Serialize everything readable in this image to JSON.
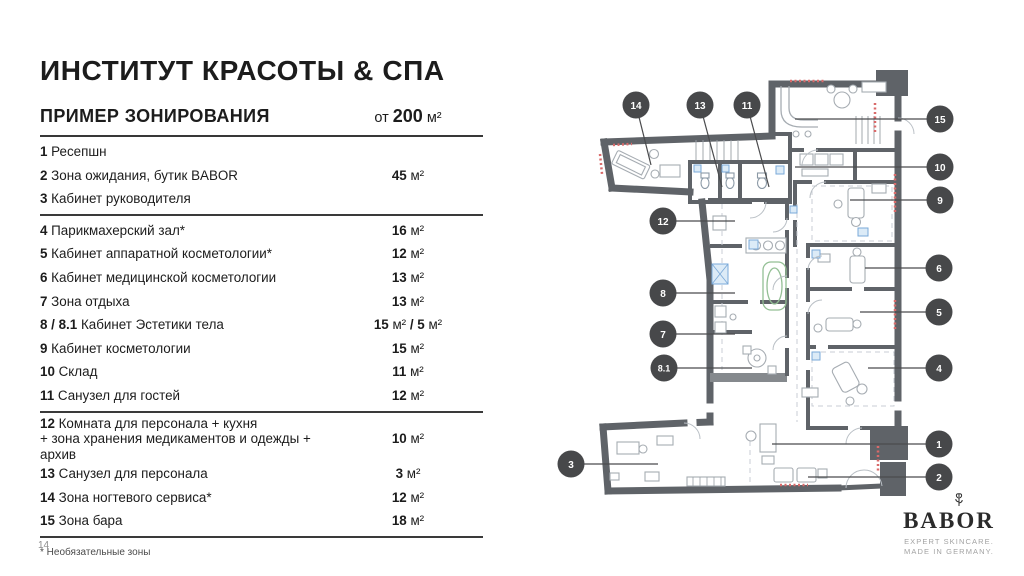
{
  "title": "ИНСТИТУТ КРАСОТЫ & СПА",
  "section": {
    "heading": "ПРИМЕР ЗОНИРОВАНИЯ",
    "min_area_prefix": "от ",
    "min_area_value": "200",
    "min_area_unit": " м²"
  },
  "zones": [
    {
      "num": "1",
      "name": "Ресепшн",
      "area_value": "",
      "area_unit": ""
    },
    {
      "num": "2",
      "name": "Зона ожидания, бутик BABOR",
      "area_value": "45",
      "area_unit": " м²"
    },
    {
      "num": "3",
      "name": "Кабинет руководителя",
      "area_value": "",
      "area_unit": "",
      "divider_after": true
    },
    {
      "num": "4",
      "name": "Парикмахерский зал*",
      "area_value": "16",
      "area_unit": " м²"
    },
    {
      "num": "5",
      "name": "Кабинет аппаратной косметологии*",
      "area_value": "12",
      "area_unit": " м²"
    },
    {
      "num": "6",
      "name": "Кабинет медицинской косметологии",
      "area_value": "13",
      "area_unit": " м²"
    },
    {
      "num": "7",
      "name": "Зона отдыха",
      "area_value": "13",
      "area_unit": " м²"
    },
    {
      "num": "8 / 8.1",
      "name": "Кабинет Эстетики тела",
      "area_value": "15",
      "area_unit": " м²",
      "area_value2": " / 5",
      "area_unit2": " м²"
    },
    {
      "num": "9",
      "name": "Кабинет косметологии",
      "area_value": "15",
      "area_unit": " м²"
    },
    {
      "num": "10",
      "name": "Склад",
      "area_value": "11",
      "area_unit": " м²"
    },
    {
      "num": "11",
      "name": "Санузел для гостей",
      "area_value": "12",
      "area_unit": " м²",
      "divider_after": true
    },
    {
      "num": "12",
      "name": "Комната для персонала + кухня",
      "name2": "+ зона хранения медикаментов и одежды + архив",
      "area_value": "10",
      "area_unit": " м²"
    },
    {
      "num": "13",
      "name": "Санузел для персонала",
      "area_value": "3",
      "area_unit": " м²"
    },
    {
      "num": "14",
      "name": "Зона ногтевого сервиса*",
      "area_value": "12",
      "area_unit": " м²"
    },
    {
      "num": "15",
      "name": "Зона бара",
      "area_value": "18",
      "area_unit": " м²",
      "divider_after": true
    }
  ],
  "footnote": "* Необязательные зоны",
  "page_number": "14",
  "plan": {
    "callouts": [
      {
        "label": "14"
      },
      {
        "label": "13"
      },
      {
        "label": "11"
      },
      {
        "label": "15"
      },
      {
        "label": "10"
      },
      {
        "label": "9"
      },
      {
        "label": "12"
      },
      {
        "label": "6"
      },
      {
        "label": "8"
      },
      {
        "label": "5"
      },
      {
        "label": "7"
      },
      {
        "label": "8.1"
      },
      {
        "label": "4"
      },
      {
        "label": "1"
      },
      {
        "label": "3"
      },
      {
        "label": "2"
      }
    ]
  },
  "brand": {
    "name": "BABOR",
    "tagline1": "EXPERT SKINCARE.",
    "tagline2": "MADE IN GERMANY."
  },
  "colors": {
    "text": "#1c1c1c",
    "wall_gray": "#5f6368",
    "furniture_gray": "#a6acb2",
    "accent_red": "#d96a6a",
    "fixture_blue": "#7aa9d8",
    "tub_green": "#93bf94",
    "callout_bg": "#47484a"
  }
}
